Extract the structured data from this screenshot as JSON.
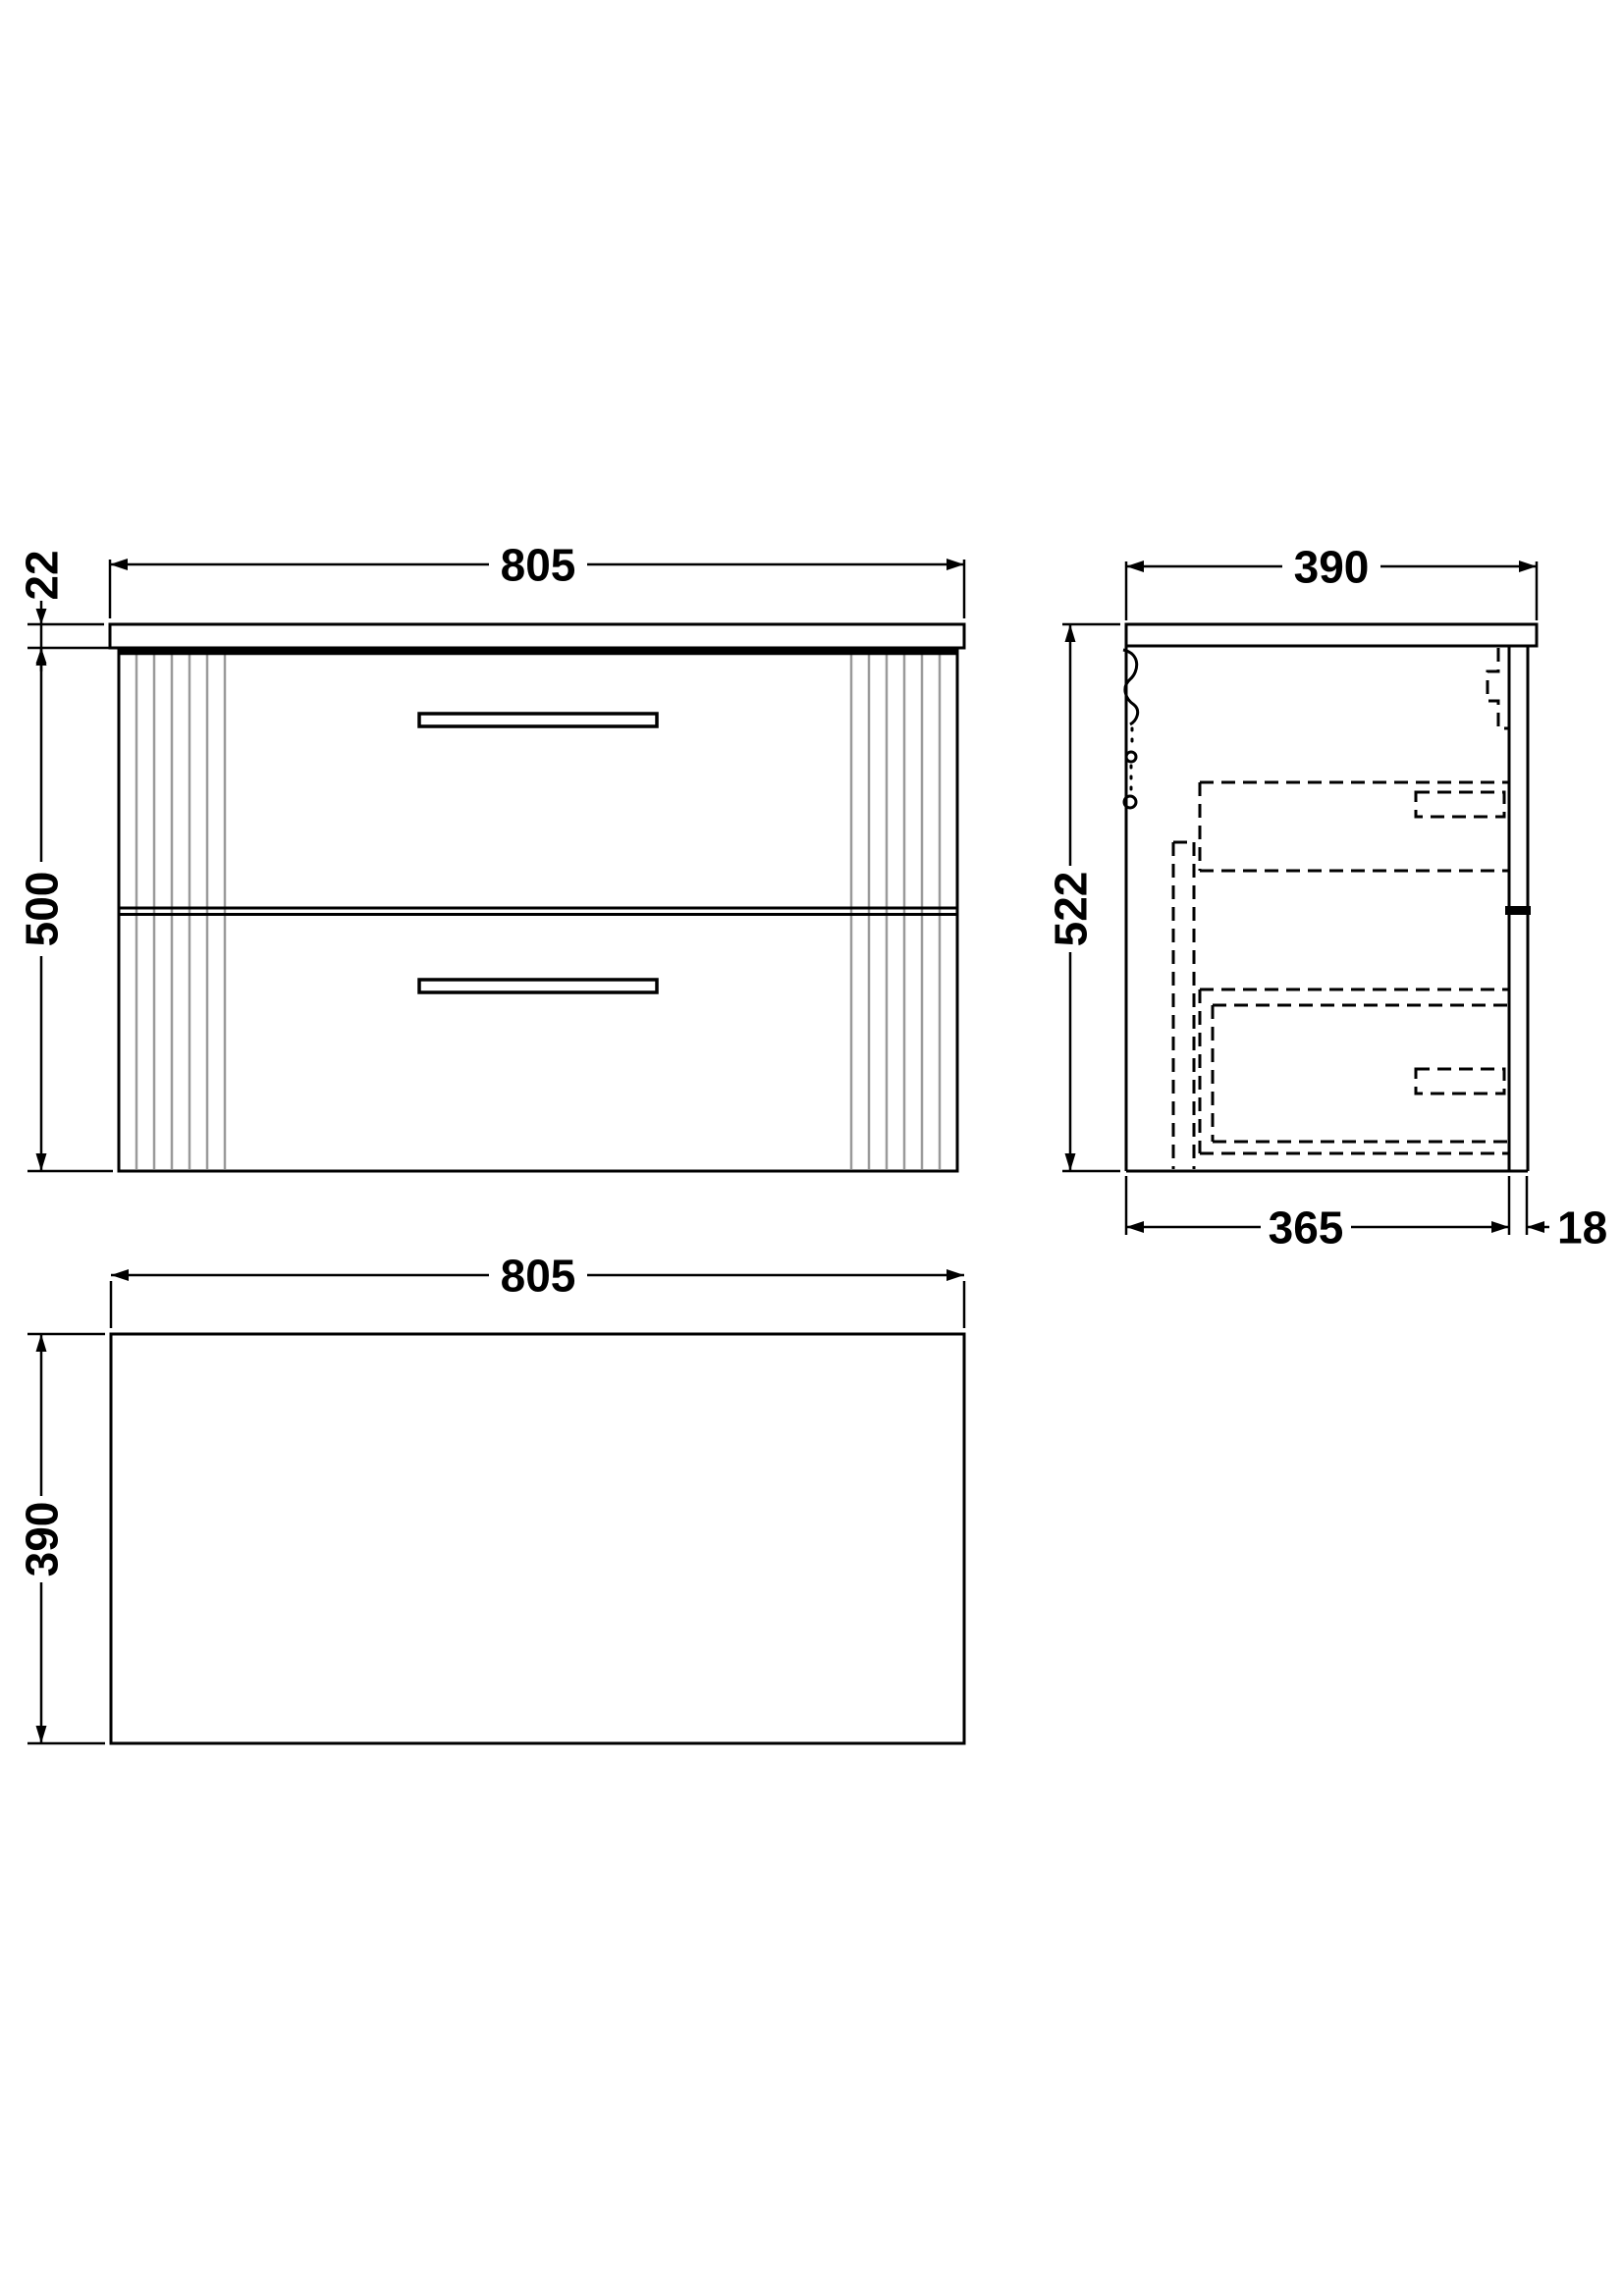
{
  "drawing": {
    "description": "Wall-hung two-drawer vanity unit technical drawing, three orthographic views",
    "front": {
      "width": "805",
      "worktop_thickness": "22",
      "cabinet_height": "500"
    },
    "side": {
      "depth": "390",
      "overall_height": "522",
      "carcass_depth": "365",
      "front_thickness": "18"
    },
    "plan": {
      "width": "805",
      "depth": "390"
    },
    "colors": {
      "line": "#000000",
      "flute": "#9a9a9a",
      "background": "#ffffff"
    }
  }
}
